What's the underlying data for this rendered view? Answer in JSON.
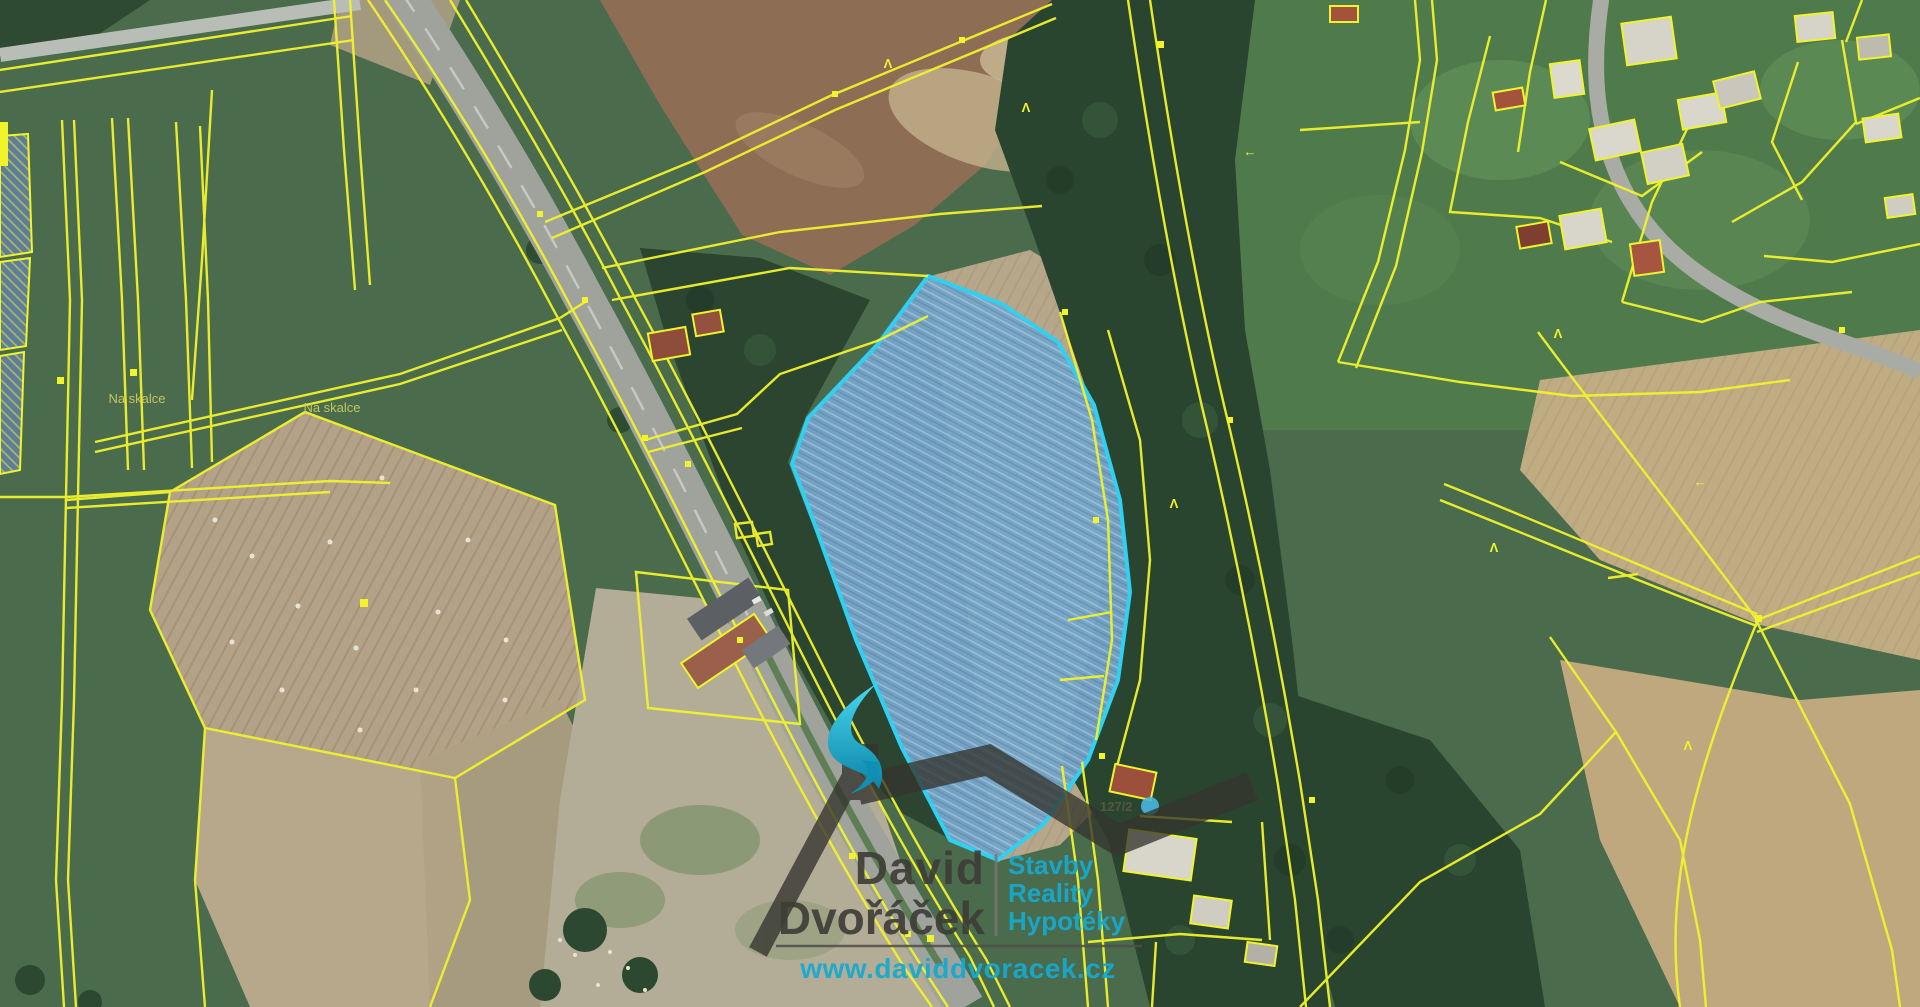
{
  "map": {
    "labels": {
      "na_skalce_1": "Na skalce",
      "na_skalce_2": "Na skalce",
      "parcel_number": "127/2"
    },
    "icons": {
      "caret_marker": "Λ",
      "arrow_left_marker": "←"
    },
    "colors": {
      "cadastral_yellow": "#f1f32b",
      "highlight_border_cyan": "#2fd0f2",
      "highlight_fill_blue": "#7d9ec0",
      "meadow_green": "#4a6b4c",
      "forest_green": "#2a452f",
      "field_tan": "#b3a287",
      "plowed_brown": "#8d6d53",
      "road_gray": "#9fa39c"
    }
  },
  "watermark": {
    "name_line1": "David",
    "name_line2": "Dvořáček",
    "services": {
      "line1": "Stavby",
      "line2": "Reality",
      "line3": "Hypotéky"
    },
    "website": "www.daviddvoracek.cz",
    "brand_teal": "#16aacf",
    "brand_dark": "#35342e"
  }
}
